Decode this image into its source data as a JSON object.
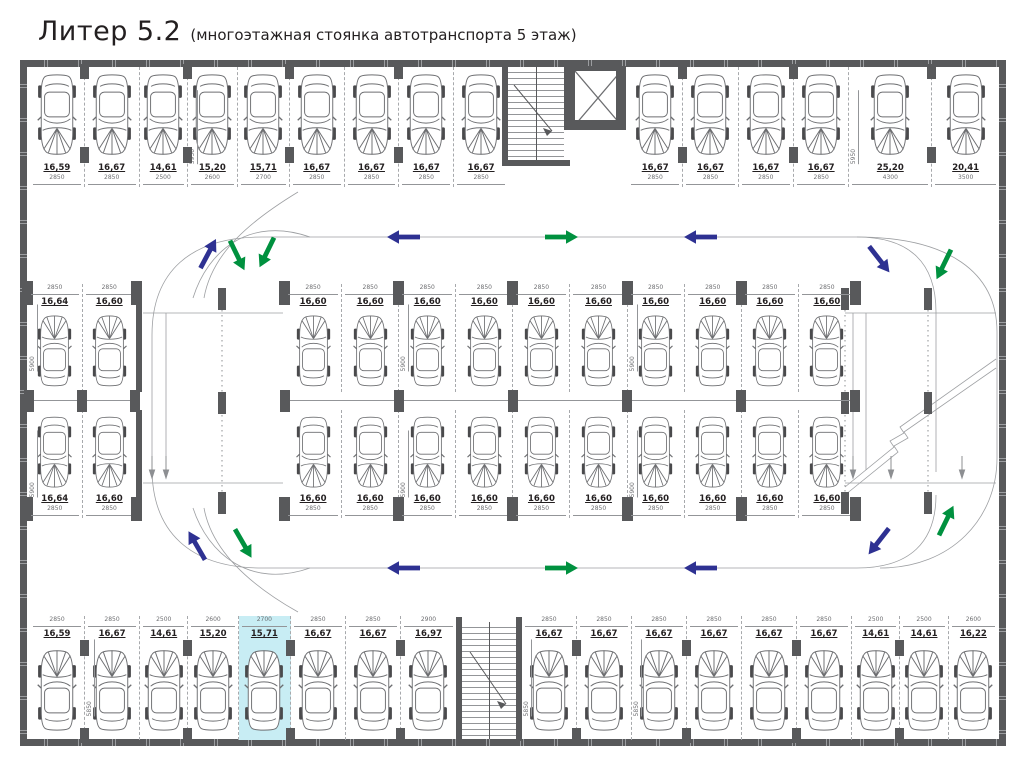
{
  "title": {
    "main": "Литер 5.2",
    "subtitle": "(многоэтажная стоянка автотранспорта 5 этаж)"
  },
  "colors": {
    "wall": "#58595b",
    "arrow_blue": "#2e3192",
    "arrow_green": "#00913f",
    "highlight": "#c8edf4"
  },
  "rows": {
    "top_left": [
      {
        "area": "16,59",
        "w": 2850
      },
      {
        "area": "16,67",
        "w": 2850
      },
      {
        "area": "14,61",
        "w": 2500
      },
      {
        "area": "15,20",
        "w": 2600,
        "depth": "5950"
      },
      {
        "area": "15,71",
        "w": 2700
      },
      {
        "area": "16,67",
        "w": 2850
      },
      {
        "area": "16,67",
        "w": 2850
      },
      {
        "area": "16,67",
        "w": 2850
      },
      {
        "area": "16,67",
        "w": 2850
      }
    ],
    "top_right": [
      {
        "area": "16,67",
        "w": 2850
      },
      {
        "area": "16,67",
        "w": 2850
      },
      {
        "area": "16,67",
        "w": 2850
      },
      {
        "area": "16,67",
        "w": 2850
      },
      {
        "area": "25,20",
        "w": 4300,
        "depth": "5950"
      },
      {
        "area": "20,41",
        "w": 3500
      }
    ],
    "left_block_top": [
      {
        "area": "16,64",
        "w": 2850,
        "depth": "5900"
      },
      {
        "area": "16,60",
        "w": 2850
      }
    ],
    "left_block_bottom": [
      {
        "area": "16,64",
        "w": 2850,
        "depth": "5900"
      },
      {
        "area": "16,60",
        "w": 2850
      }
    ],
    "center_top": [
      {
        "area": "16,60",
        "w": 2850
      },
      {
        "area": "16,60",
        "w": 2850
      },
      {
        "area": "16,60",
        "w": 2850,
        "depth": "5900"
      },
      {
        "area": "16,60",
        "w": 2850
      },
      {
        "area": "16,60",
        "w": 2850
      },
      {
        "area": "16,60",
        "w": 2850
      },
      {
        "area": "16,60",
        "w": 2850,
        "depth": "5900"
      },
      {
        "area": "16,60",
        "w": 2850
      },
      {
        "area": "16,60",
        "w": 2850
      },
      {
        "area": "16,60",
        "w": 2850
      }
    ],
    "center_bottom": [
      {
        "area": "16,60",
        "w": 2850
      },
      {
        "area": "16,60",
        "w": 2850
      },
      {
        "area": "16,60",
        "w": 2850,
        "depth": "5900"
      },
      {
        "area": "16,60",
        "w": 2850
      },
      {
        "area": "16,60",
        "w": 2850
      },
      {
        "area": "16,60",
        "w": 2850
      },
      {
        "area": "16,60",
        "w": 2850,
        "depth": "5900"
      },
      {
        "area": "16,60",
        "w": 2850
      },
      {
        "area": "16,60",
        "w": 2850
      },
      {
        "area": "16,60",
        "w": 2850
      }
    ],
    "bottom_left": [
      {
        "area": "16,59",
        "w": 2850
      },
      {
        "area": "16,67",
        "w": 2850,
        "depth": "5850"
      },
      {
        "area": "14,61",
        "w": 2500
      },
      {
        "area": "15,20",
        "w": 2600
      },
      {
        "area": "15,71",
        "w": 2700,
        "hl": true
      },
      {
        "area": "16,67",
        "w": 2850
      },
      {
        "area": "16,67",
        "w": 2850
      },
      {
        "area": "16,97",
        "w": 2900
      }
    ],
    "bottom_right": [
      {
        "area": "16,67",
        "w": 2850,
        "depth": "5850"
      },
      {
        "area": "16,67",
        "w": 2850
      },
      {
        "area": "16,67",
        "w": 2850,
        "depth": "5850"
      },
      {
        "area": "16,67",
        "w": 2850
      },
      {
        "area": "16,67",
        "w": 2850
      },
      {
        "area": "16,67",
        "w": 2850
      },
      {
        "area": "14,61",
        "w": 2500
      },
      {
        "area": "14,61",
        "w": 2500
      },
      {
        "area": "16,22",
        "w": 2600
      }
    ]
  },
  "arrows": [
    {
      "x": 404,
      "y": 237,
      "r": 180,
      "c": "b"
    },
    {
      "x": 561,
      "y": 237,
      "r": 0,
      "c": "g"
    },
    {
      "x": 701,
      "y": 237,
      "r": 180,
      "c": "b"
    },
    {
      "x": 208,
      "y": 254,
      "r": -62,
      "c": "b"
    },
    {
      "x": 237,
      "y": 255,
      "r": 64,
      "c": "g"
    },
    {
      "x": 267,
      "y": 252,
      "r": 116,
      "c": "g"
    },
    {
      "x": 879,
      "y": 259,
      "r": 52,
      "c": "b"
    },
    {
      "x": 944,
      "y": 264,
      "r": 116,
      "c": "g"
    },
    {
      "x": 404,
      "y": 568,
      "r": 180,
      "c": "b"
    },
    {
      "x": 561,
      "y": 568,
      "r": 0,
      "c": "g"
    },
    {
      "x": 701,
      "y": 568,
      "r": 180,
      "c": "b"
    },
    {
      "x": 197,
      "y": 546,
      "r": -120,
      "c": "b"
    },
    {
      "x": 243,
      "y": 543,
      "r": 60,
      "c": "g"
    },
    {
      "x": 879,
      "y": 541,
      "r": 128,
      "c": "b"
    },
    {
      "x": 946,
      "y": 521,
      "r": -64,
      "c": "g"
    }
  ]
}
